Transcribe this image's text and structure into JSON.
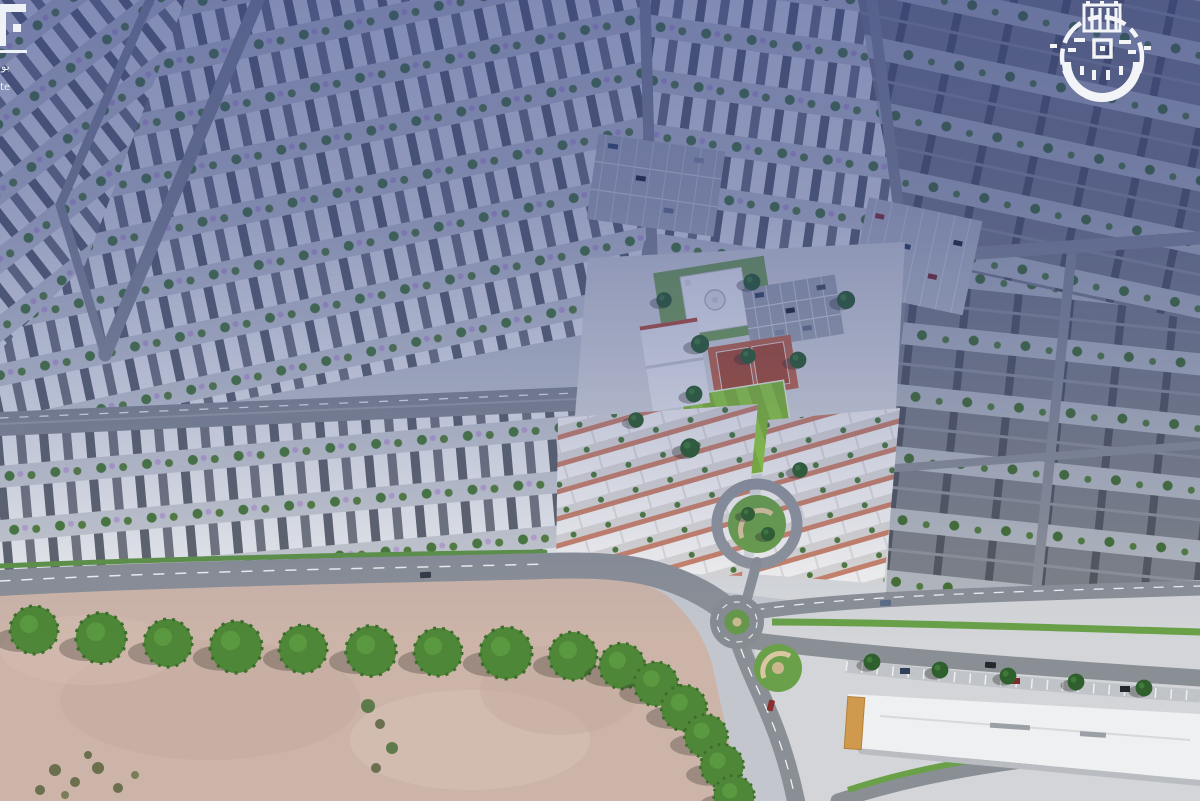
{
  "branding": {
    "left_logo": {
      "icon": "partial-developer-logo",
      "arabic_fragment": "بوا",
      "latin_fragment": "ate",
      "color": "#eef1f6"
    },
    "right_logo": {
      "icon": "municipality-kufic-emblem-icon",
      "color": "#f2f4f7"
    }
  },
  "scene_palette": {
    "tint_top": "#2c3c86",
    "sand": "#ccb4a8",
    "road": "#8a8f96",
    "field_green": "#86bf36",
    "court_orange": "#bf6243",
    "tree_green": "#4e8737",
    "lawn_green": "#74a455",
    "roof_light": "#e8eaec",
    "roof_dark": "#7d8187",
    "commercial_roof": "#eff0f1",
    "entrance_orange": "#cf9a4e"
  }
}
